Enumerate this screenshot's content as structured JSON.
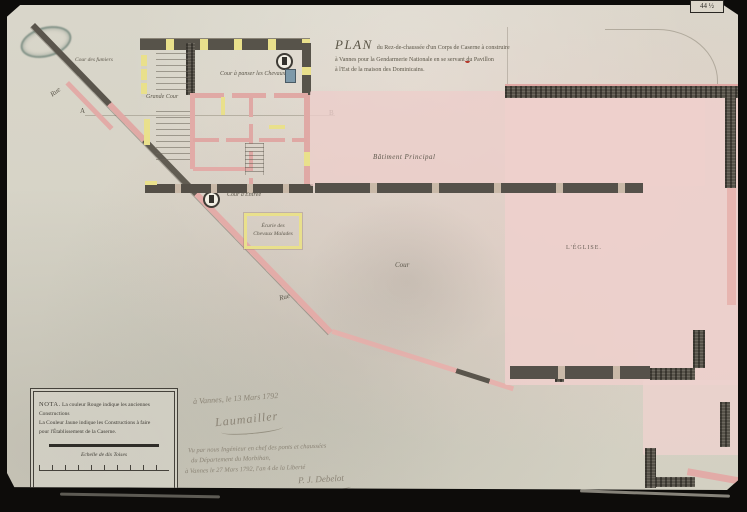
{
  "photo": {
    "catalog_tag": "44 ½"
  },
  "title": {
    "word": "PLAN",
    "line1_rest": "du Rez-de-chaussée d'un Corps de Caserne à construire",
    "line2": "à Vannes pour la Gendarmerie Nationale en se servant du Pavillon",
    "line3": "à l'Est de la maison des Dominicains."
  },
  "plan_labels": {
    "rue_upper": "Rue",
    "rue_lower": "Rue",
    "cour_des_fumiers": "Cour des fumiers",
    "grande_cour": "Grande Cour",
    "cour_a_panser": "Cour à panser les Chevaux",
    "cour_d_entree": "Cour d'Entrée",
    "ecurie_line1": "Écurie des",
    "ecurie_line2": "Chevaux Malades",
    "batiment_principal": "Bâtiment Principal",
    "cour": "Cour",
    "eglise": "L'ÉGLISE.",
    "point_a": "A",
    "point_b": "B"
  },
  "nota": {
    "heading": "NOTA.",
    "line1": "La couleur Rouge indique les anciennes",
    "line2": "Constructions",
    "line3": "La Couleur Jaune indique les Constructions à faire",
    "line4": "pour l'Établissement de la Caserne.",
    "scale_caption": "Echelle de dix Toises"
  },
  "manuscript": {
    "date_line": "à Vannes, le 13 Mars 1792",
    "signature1": "Laumailler",
    "approval1": "Vu par nous Ingénieur en chef des ponts et chaussées",
    "approval2": "du Département du Morbihan,",
    "approval3": "à Vannes le 27 Mars 1792, l'an 4 de la Liberté",
    "signature2": "P. J. Debelot"
  },
  "colors": {
    "photo_bg": "#0d0c0a",
    "paper": "#d7d3c6",
    "pink_wash": "#eed2ce",
    "pink_wall": "#e2aba7",
    "yellow_wall": "#e9e08c",
    "dark_wall": "#57534a",
    "ink": "#5d584c",
    "handwriting": "#8b8476",
    "stamp_green": "#34564c",
    "red_mark": "#b5392c"
  }
}
